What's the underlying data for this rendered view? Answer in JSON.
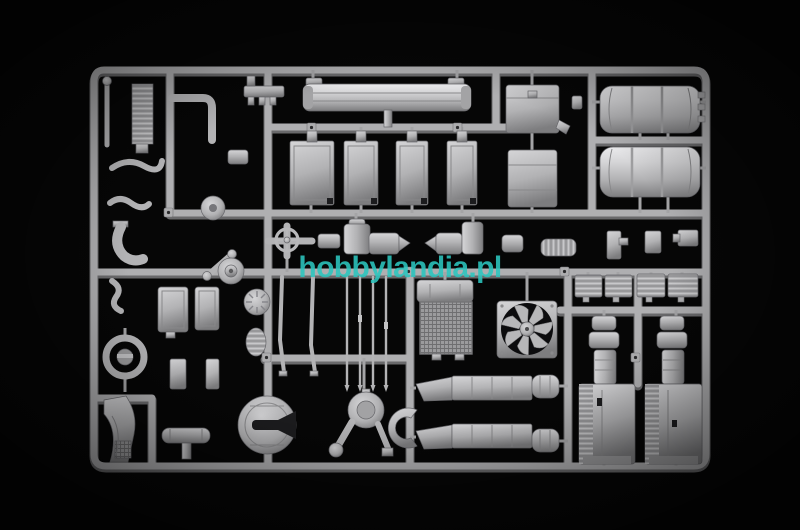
{
  "watermark": {
    "text": "hobbylandia.pl",
    "color": "#2cc6bf"
  },
  "palette": {
    "background": "#060606",
    "plastic_bright": "#e7e7e9",
    "plastic_light": "#d5d5d7",
    "plastic_mid": "#b2b2b4",
    "plastic_dark": "#7d7d7f",
    "runner_face": "#afafb1",
    "runner_shadow": "#69696b",
    "gate": "#a4a4a6"
  },
  "sprue": {
    "parts": [
      "front-bumper",
      "mud-flap-boxes",
      "battery-box",
      "fuel-tank-upper",
      "fuel-tank-lower",
      "air-tanks-and-cylinders",
      "valve-handwheel",
      "ladder-core",
      "pipes-and-hoses",
      "pulley-disc",
      "wheel-hub",
      "ribbed-disc",
      "cab-panels",
      "steering-ring",
      "front-fender",
      "muffler",
      "fifth-wheel-coupling",
      "exhaust-rods",
      "radiator-core",
      "cooling-fan",
      "transfer-gearbox",
      "crescent-bracket",
      "exhaust-ducts",
      "step-boxes",
      "engine-block-left",
      "engine-block-right"
    ]
  }
}
